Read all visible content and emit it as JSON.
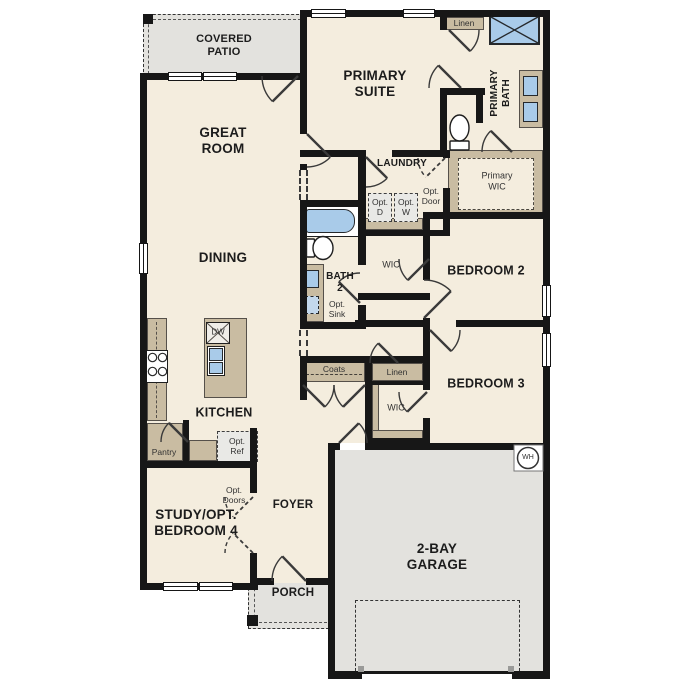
{
  "rooms": {
    "covered_patio": "COVERED\nPATIO",
    "great_room": "GREAT\nROOM",
    "dining": "DINING",
    "kitchen": "KITCHEN",
    "primary_suite": "PRIMARY\nSUITE",
    "primary_bath": "PRIMARY\nBATH",
    "primary_wic": "Primary\nWIC",
    "laundry": "LAUNDRY",
    "bath2": "BATH\n2",
    "bedroom2": "BEDROOM 2",
    "bedroom3": "BEDROOM 3",
    "study": "STUDY/OPT.\nBEDROOM 4",
    "foyer": "FOYER",
    "porch": "PORCH",
    "garage": "2-BAY\nGARAGE"
  },
  "closets": {
    "linen_bath": "Linen",
    "linen_hall": "Linen",
    "wic_bed2": "WIC",
    "wic_bed3": "WIC",
    "coats": "Coats",
    "pantry": "Pantry"
  },
  "options": {
    "opt_dryer": "Opt.\nD",
    "opt_washer": "Opt.\nW",
    "opt_door": "Opt.\nDoor",
    "opt_sink": "Opt.\nSink",
    "opt_ref": "Opt.\nRef",
    "opt_doors": "Opt.\nDoors"
  },
  "appliances": {
    "dishwasher": "DW",
    "water_heater": "WH"
  },
  "colors": {
    "wall": "#171717",
    "floor": "#f4edde",
    "patio_gray": "#e3e2de",
    "cabinet_tan": "#c9bca2",
    "fixture_blue": "#a9cbe9"
  }
}
